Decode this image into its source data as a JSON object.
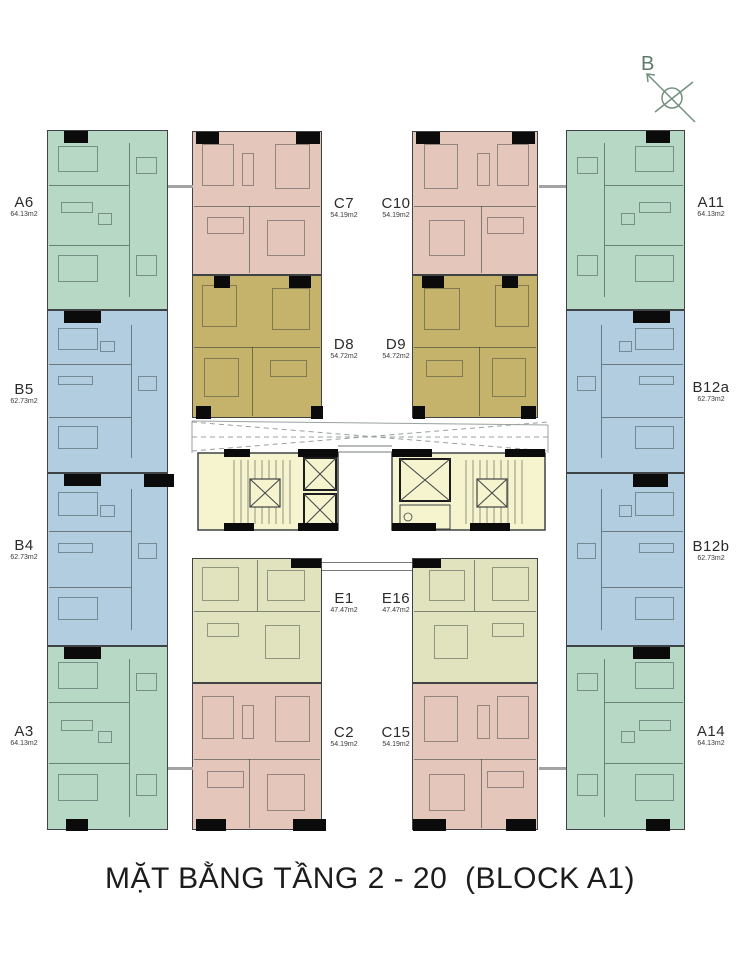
{
  "title": "MẶT BẰNG TẦNG 2 - 20  (BLOCK A1)",
  "compass_label": "B",
  "colors": {
    "A": "#b7d8c5",
    "B": "#b2cddf",
    "C": "#e5c6bb",
    "D": "#c6b36b",
    "E": "#e0e3bd",
    "core": "#f5f4cf",
    "wall": "#3f4345",
    "black_wall": "#0b0b0b",
    "connector_gray": "#a3a3a3",
    "compass_green": "#74907e",
    "title_color": "#1c1c1c"
  },
  "units": [
    {
      "name": "A6",
      "area": "64.13m2",
      "type": "A",
      "x": 47,
      "y": 130,
      "w": 121,
      "h": 180,
      "flip": false,
      "label": {
        "x": 2,
        "y": 195,
        "w": 44
      },
      "bars": [
        [
          16,
          0,
          24,
          12
        ]
      ]
    },
    {
      "name": "B5",
      "area": "62.73m2",
      "type": "B",
      "x": 47,
      "y": 310,
      "w": 121,
      "h": 163,
      "flip": false,
      "label": {
        "x": 2,
        "y": 382,
        "w": 44
      },
      "bars": [
        [
          16,
          0,
          37,
          12
        ]
      ]
    },
    {
      "name": "B4",
      "area": "62.73m2",
      "type": "B",
      "x": 47,
      "y": 473,
      "w": 121,
      "h": 173,
      "flip": false,
      "label": {
        "x": 2,
        "y": 538,
        "w": 44
      },
      "bars": [
        [
          16,
          0,
          37,
          12
        ],
        [
          96,
          0,
          30,
          13
        ]
      ]
    },
    {
      "name": "A3",
      "area": "64.13m2",
      "type": "A",
      "x": 47,
      "y": 646,
      "w": 121,
      "h": 184,
      "flip": false,
      "label": {
        "x": 2,
        "y": 724,
        "w": 44
      },
      "bars": [
        [
          16,
          0,
          37,
          12
        ],
        [
          18,
          172,
          22,
          12
        ]
      ]
    },
    {
      "name": "C7",
      "area": "54.19m2",
      "type": "C",
      "x": 192,
      "y": 131,
      "w": 130,
      "h": 144,
      "flip": false,
      "label": {
        "x": 324,
        "y": 196,
        "w": 40
      },
      "bars": [
        [
          3,
          0,
          23,
          12
        ],
        [
          103,
          0,
          24,
          12
        ]
      ]
    },
    {
      "name": "D8",
      "area": "54.72m2",
      "type": "D",
      "x": 192,
      "y": 275,
      "w": 130,
      "h": 143,
      "flip": false,
      "label": {
        "x": 324,
        "y": 337,
        "w": 40
      },
      "bars": [
        [
          21,
          0,
          16,
          12
        ],
        [
          96,
          0,
          22,
          12
        ],
        [
          3,
          130,
          15,
          13
        ],
        [
          118,
          130,
          12,
          13
        ]
      ]
    },
    {
      "name": "E1",
      "area": "47.47m2",
      "type": "E",
      "x": 192,
      "y": 558,
      "w": 130,
      "h": 125,
      "flip": false,
      "label": {
        "x": 324,
        "y": 591,
        "w": 40
      },
      "bars": [
        [
          98,
          0,
          30,
          9
        ]
      ]
    },
    {
      "name": "C2",
      "area": "54.19m2",
      "type": "C",
      "x": 192,
      "y": 683,
      "w": 130,
      "h": 147,
      "flip": false,
      "label": {
        "x": 324,
        "y": 725,
        "w": 40
      },
      "bars": [
        [
          3,
          135,
          30,
          12
        ],
        [
          100,
          135,
          33,
          12
        ]
      ]
    },
    {
      "name": "C10",
      "area": "54.19m2",
      "type": "C",
      "x": 412,
      "y": 131,
      "w": 126,
      "h": 144,
      "flip": true,
      "label": {
        "x": 376,
        "y": 196,
        "w": 40
      },
      "bars": [
        [
          3,
          0,
          24,
          12
        ],
        [
          99,
          0,
          23,
          12
        ]
      ]
    },
    {
      "name": "D9",
      "area": "54.72m2",
      "type": "D",
      "x": 412,
      "y": 275,
      "w": 126,
      "h": 143,
      "flip": true,
      "label": {
        "x": 376,
        "y": 337,
        "w": 40
      },
      "bars": [
        [
          9,
          0,
          22,
          12
        ],
        [
          89,
          0,
          16,
          12
        ],
        [
          0,
          130,
          12,
          13
        ],
        [
          108,
          130,
          15,
          13
        ]
      ]
    },
    {
      "name": "E16",
      "area": "47.47m2",
      "type": "E",
      "x": 412,
      "y": 558,
      "w": 126,
      "h": 125,
      "flip": true,
      "label": {
        "x": 376,
        "y": 591,
        "w": 40
      },
      "bars": [
        [
          0,
          0,
          28,
          9
        ]
      ]
    },
    {
      "name": "C15",
      "area": "54.19m2",
      "type": "C",
      "x": 412,
      "y": 683,
      "w": 126,
      "h": 147,
      "flip": true,
      "label": {
        "x": 376,
        "y": 725,
        "w": 40
      },
      "bars": [
        [
          0,
          135,
          33,
          12
        ],
        [
          93,
          135,
          30,
          12
        ]
      ]
    },
    {
      "name": "A11",
      "area": "64.13m2",
      "type": "A",
      "x": 566,
      "y": 130,
      "w": 119,
      "h": 180,
      "flip": true,
      "label": {
        "x": 688,
        "y": 195,
        "w": 46
      },
      "bars": [
        [
          79,
          0,
          24,
          12
        ]
      ]
    },
    {
      "name": "B12a",
      "area": "62.73m2",
      "type": "B",
      "x": 566,
      "y": 310,
      "w": 119,
      "h": 163,
      "flip": true,
      "label": {
        "x": 688,
        "y": 380,
        "w": 46
      },
      "bars": [
        [
          66,
          0,
          37,
          12
        ]
      ]
    },
    {
      "name": "B12b",
      "area": "62.73m2",
      "type": "B",
      "x": 566,
      "y": 473,
      "w": 119,
      "h": 173,
      "flip": true,
      "label": {
        "x": 688,
        "y": 539,
        "w": 46
      },
      "bars": [
        [
          66,
          0,
          35,
          13
        ]
      ]
    },
    {
      "name": "A14",
      "area": "64.13m2",
      "type": "A",
      "x": 566,
      "y": 646,
      "w": 119,
      "h": 184,
      "flip": true,
      "label": {
        "x": 688,
        "y": 724,
        "w": 46
      },
      "bars": [
        [
          66,
          0,
          37,
          12
        ],
        [
          79,
          172,
          24,
          12
        ]
      ]
    }
  ]
}
